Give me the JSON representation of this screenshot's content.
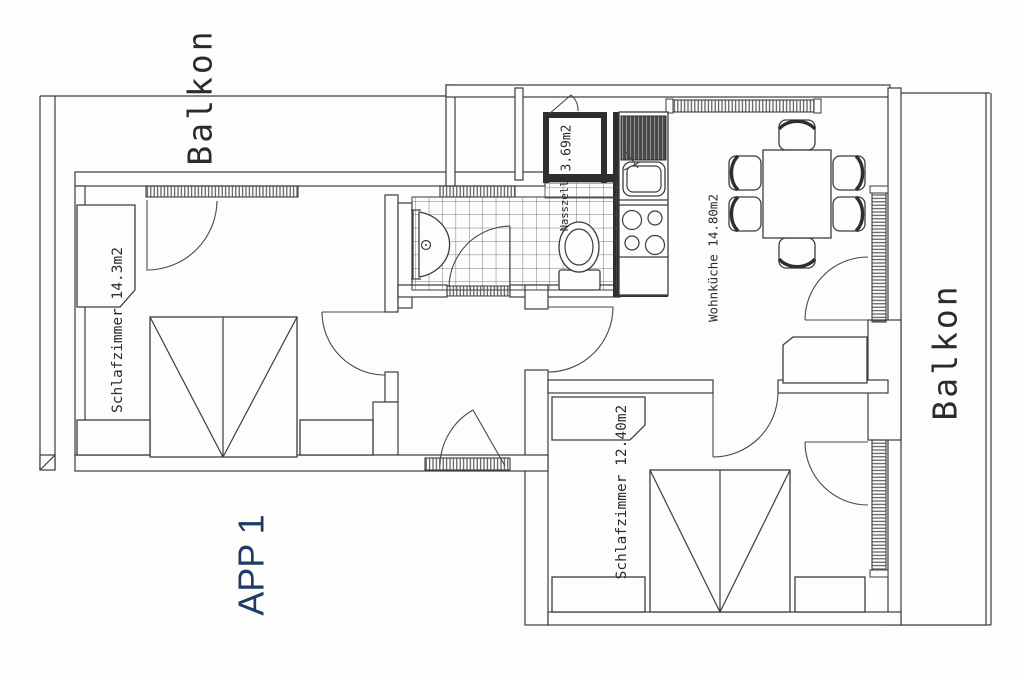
{
  "title": "APP 1",
  "colors": {
    "background": "#fdfdfb",
    "line": "#3c3c3c",
    "dark_wall": "#2e2e2e",
    "accent_blue": "#1f3a66"
  },
  "labels": {
    "balcony_top": "Balkon",
    "balcony_right": "Balkon",
    "bedroom1": "Schlafzimmer 14.3m2",
    "bedroom2": "Schlafzimmer 12.40m2",
    "living_kitchen": "Wohnküche 14.80m2",
    "wet_room": "Nasszell",
    "wet_room_area": "3.69m2",
    "apartment": "APP 1"
  },
  "rooms": [
    {
      "name": "Schlafzimmer",
      "area": "14.3m2"
    },
    {
      "name": "Schlafzimmer",
      "area": "12.40m2"
    },
    {
      "name": "Wohnküche",
      "area": "14.80m2"
    },
    {
      "name": "Nasszell",
      "area": "3.69m2"
    },
    {
      "name": "Balkon",
      "area": ""
    },
    {
      "name": "Balkon",
      "area": ""
    }
  ]
}
